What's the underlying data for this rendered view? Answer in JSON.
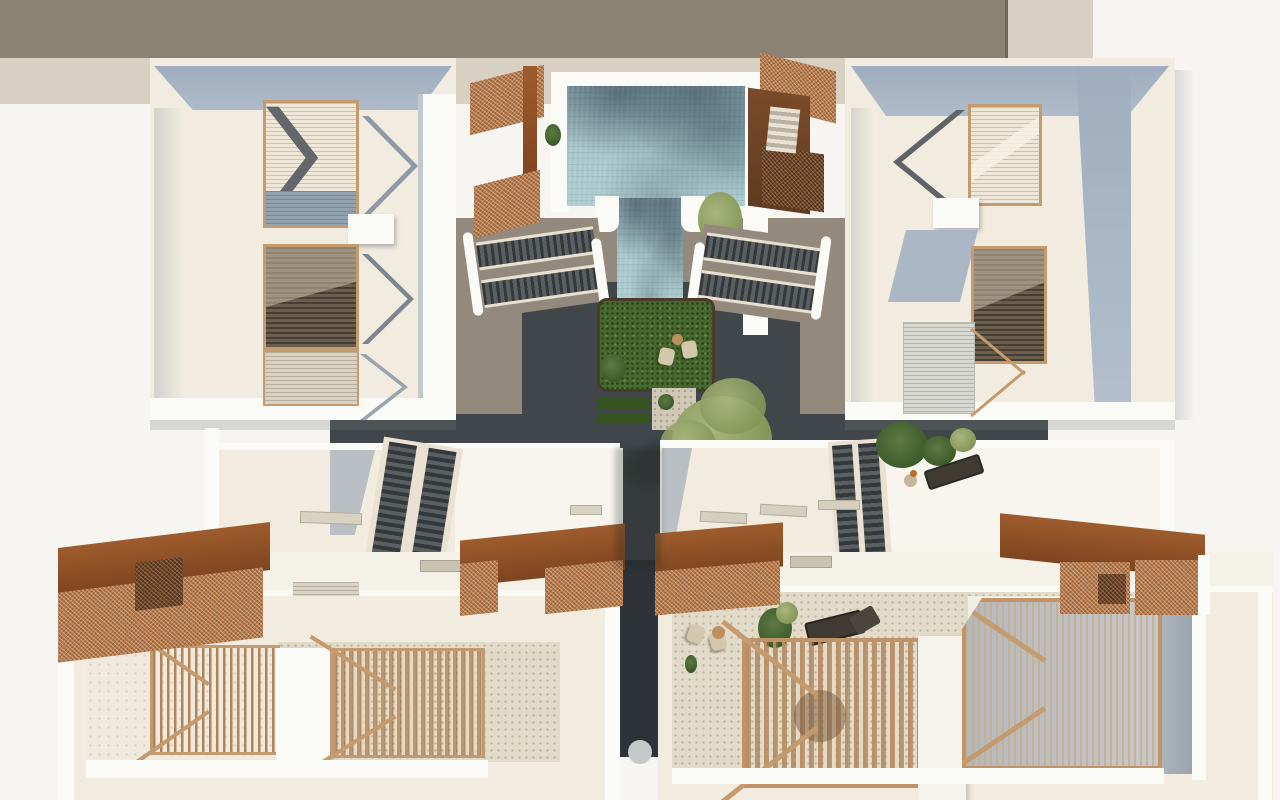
{
  "meta": {
    "type": "architectural-3d-render",
    "view": "top-down-aerial",
    "width_px": 1280,
    "height_px": 800
  },
  "colors": {
    "bg": "#f6f5f2",
    "neighborRoof": "#8b8274",
    "neighborEdge": "#d7d0c3",
    "roofCream": "#f1ecdf",
    "parapetWhite": "#fafaf6",
    "shadowBlue": "#a3b1c2",
    "softShadow": "#bcc1c2",
    "poolDeep": "#8298a3",
    "poolLight": "#abcbce",
    "walkway": "#41464b",
    "walkwayDark": "#2d3338",
    "deckTaupe": "#94897d",
    "grass": "#47682f",
    "hedge": "#35531f",
    "gravel": "#d0c9b8",
    "copper": "#9e5c2d",
    "copperLight": "#b77a4a",
    "woodTan": "#c39b6e",
    "woodSlat": "#b08457",
    "louverDark": "#6b5e4e",
    "louverLight": "#e9e2d2",
    "stairTread": "#34383a",
    "patioTile": "#e3dbc9",
    "treeOlive": "#97a566",
    "shrub": "#43602f",
    "loungerDark": "#3f3b33",
    "seatBeige": "#d3c8ac",
    "tableWood": "#bb8f5e"
  },
  "scene": {
    "description": "Top-down aerial rendering of a residential complex: two upper apartment blocks with louvered roof skylights flank a swimming pool and sunken garden courtyard; twin staircases descend beside the pool; mid-level roof terraces with escalator-like stairs and a planted terrace; corten mesh pergolas; two lower row-house blocks with slatted timber patio screens, lounge furniture and planting.",
    "areas": {
      "neighbor_roof_band": "adjacent building roof along top edge",
      "upper_left_block": "apartment block, louvered skylights",
      "upper_right_block": "apartment block, louvered skylights",
      "pool": "rippled swimming pool with white deck",
      "courtyard_garden": "lawn, lounge chairs, side table, shrub, hedges, gravel, olive tree",
      "stairs": "twin dark staircases flanking pool",
      "mid_roofs": "lower roof level with escalator stairs and plant terrace",
      "pergolas": "rust corten mesh canopies",
      "lower_left_block": "patios with vertical timber slat screens",
      "lower_right_block": "patios with timber pergolas, loungers, armchairs, plants",
      "walkways": "dark paved circulation paths"
    }
  }
}
